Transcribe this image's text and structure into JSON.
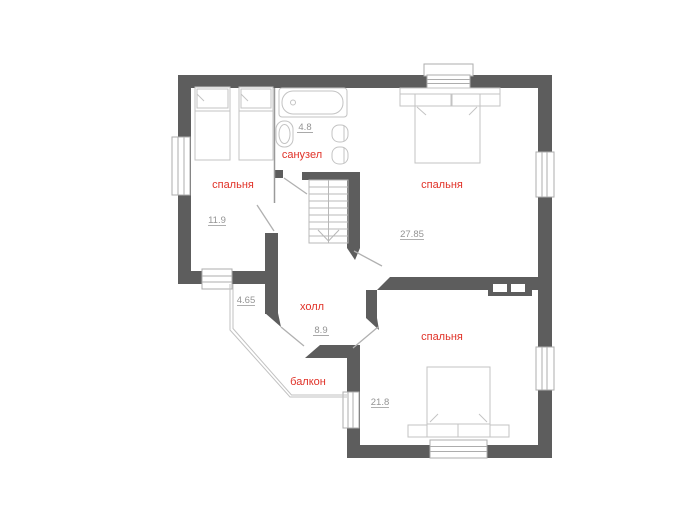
{
  "plan_title": "floor-plan-second-storey",
  "colors": {
    "wall": "#5d5d5d",
    "label": "#e03127",
    "dimension": "#949494",
    "furniture": "#c3c3c3"
  },
  "rooms": {
    "bedroom_left": {
      "label": "спальня",
      "area": "11.9"
    },
    "bathroom": {
      "label": "санузел",
      "area": "4.8"
    },
    "bedroom_top_right": {
      "label": "спальня",
      "area": "27.85"
    },
    "hall": {
      "label": "холл",
      "area": "8.9"
    },
    "balcony": {
      "label": "балкон",
      "area": "4.65"
    },
    "bedroom_bottom_right": {
      "label": "спальня",
      "area": "21.8"
    }
  }
}
